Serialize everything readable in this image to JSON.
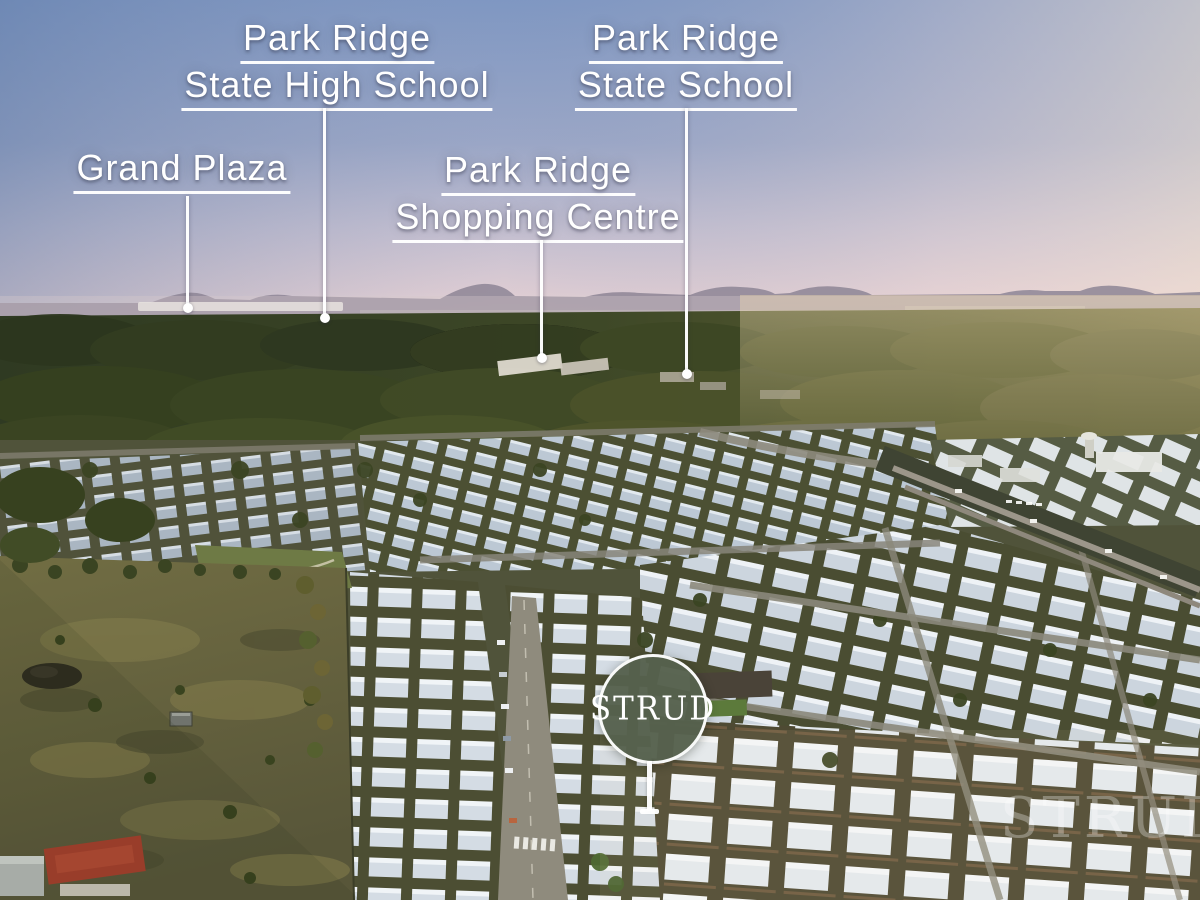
{
  "labels": {
    "grand_plaza": {
      "text": "Grand Plaza"
    },
    "high_school": {
      "line1": "Park Ridge",
      "line2": "State High School"
    },
    "shopping_centre": {
      "line1": "Park Ridge",
      "line2": "Shopping Centre"
    },
    "state_school": {
      "line1": "Park Ridge",
      "line2": "State School"
    }
  },
  "logo": {
    "text": "STRUD"
  },
  "watermark": {
    "text": "STRUD"
  },
  "colors": {
    "logo_green": "#56614d",
    "label_text": "#ffffff",
    "leader_line": "#ffffff",
    "sky_top_left": "#7f97c2",
    "sky_horizon_right": "#f6e8d2"
  }
}
